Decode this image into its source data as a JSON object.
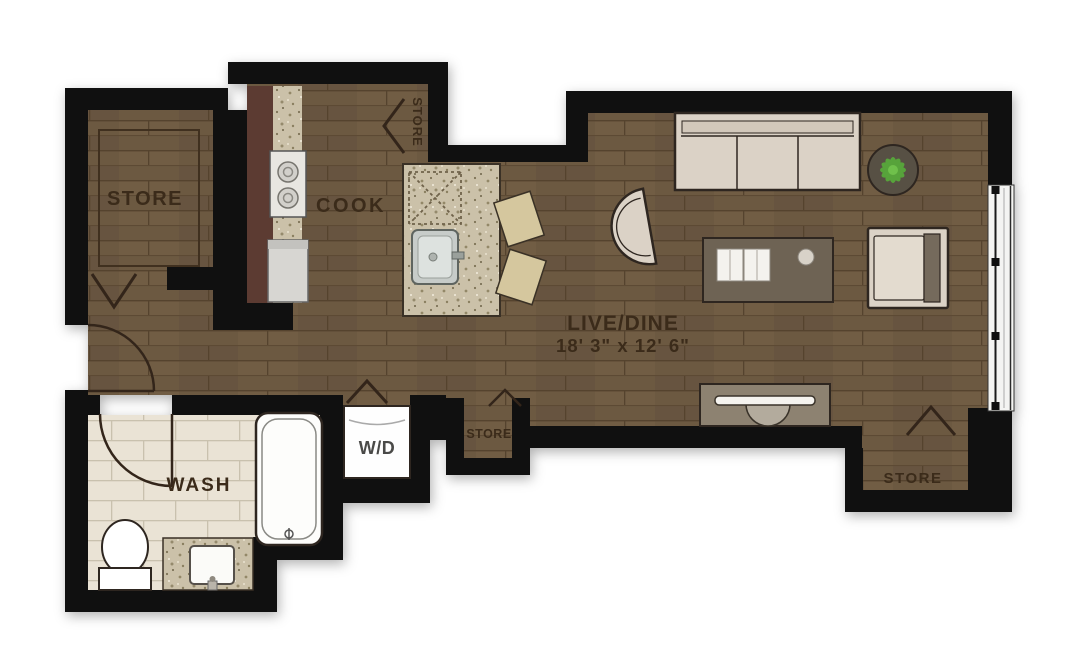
{
  "floorplan": {
    "colors": {
      "wall": "#101010",
      "wood_floor": "#6c5941",
      "tile_floor": "#eae3d5",
      "granite": "#cbc1a9",
      "cabinet_red": "#5c3b32",
      "furniture_tan": "#dbd2c6",
      "table_brown": "#6e6354",
      "console_gray": "#8d8271",
      "plant_green": "#58a83b",
      "label_text": "#3b2b1a"
    },
    "labels": {
      "store_room": "STORE",
      "cook": "COOK",
      "live_dine": "LIVE/DINE",
      "live_dine_dimensions": "18' 3\" x 12' 6\"",
      "wash": "WASH",
      "washer_dryer": "W/D",
      "store_closet_kitchen": "STORE",
      "store_hall": "STORE",
      "store_corner": "STORE"
    }
  }
}
